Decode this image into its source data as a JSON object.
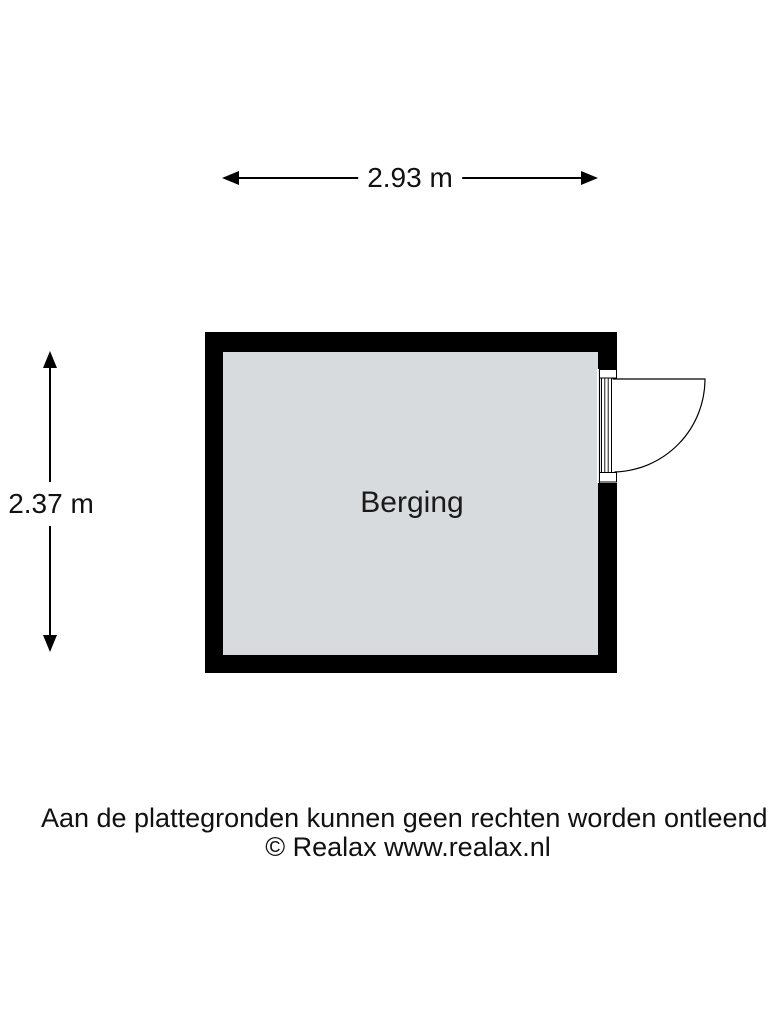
{
  "floorplan": {
    "room": {
      "label": "Berging",
      "fill_color": "#d8dbdd",
      "wall_color": "#000000"
    },
    "dimensions": {
      "width_label": "2.93 m",
      "height_label": "2.37 m"
    },
    "door": {
      "wall": "right",
      "swing": "outward"
    },
    "footer": {
      "disclaimer": "Aan de plattegronden kunnen geen rechten worden ontleend.",
      "copyright": "© Realax www.realax.nl"
    }
  }
}
